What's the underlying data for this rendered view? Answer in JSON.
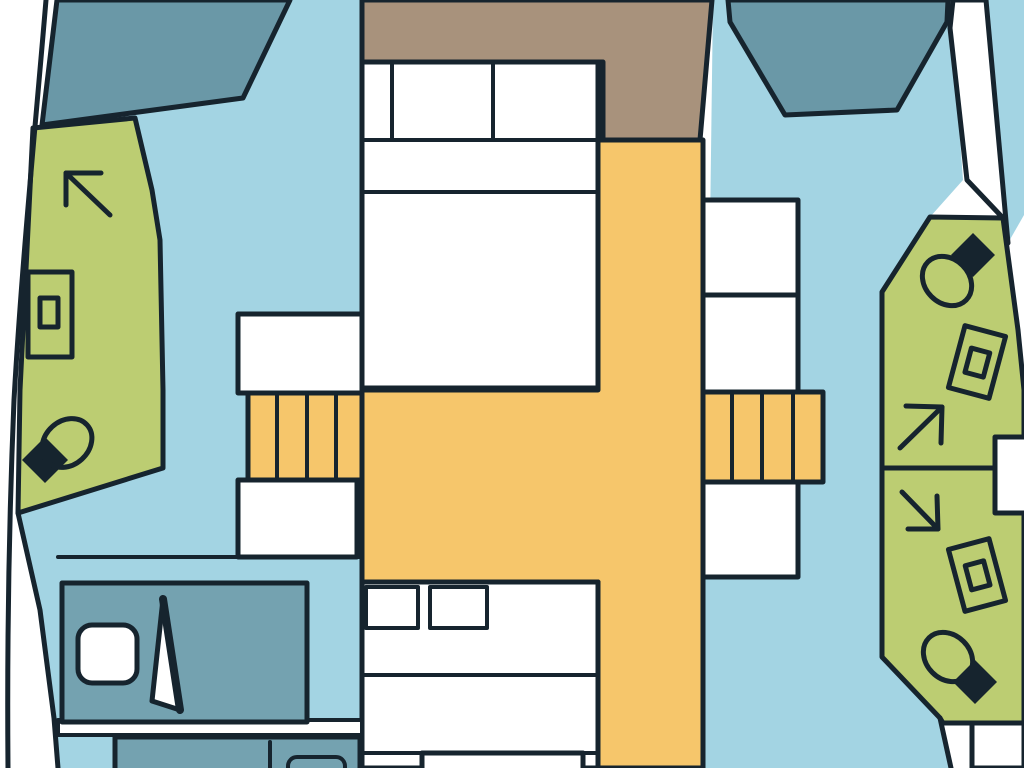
{
  "meta": {
    "type": "boat-floorplan-diagram",
    "subject": "catamaran-deck-layout-top-view",
    "canvas": {
      "width": 1024,
      "height": 768
    },
    "text_content": "none"
  },
  "colors": {
    "outline": "#16242e",
    "white": "#ffffff",
    "hull_interior": "#a3d4e3",
    "window_glass": "#6a98a7",
    "berth_teal": "#74a2b0",
    "bathroom_green": "#bccd72",
    "saloon_orange": "#f6c66b",
    "foredeck_tan": "#a8927c"
  },
  "rooms": [
    {
      "id": "left-hull",
      "fill": "hull_interior"
    },
    {
      "id": "right-hull",
      "fill": "hull_interior"
    },
    {
      "id": "foredeck",
      "fill": "foredeck_tan"
    },
    {
      "id": "saloon-walkway",
      "fill": "saloon_orange"
    },
    {
      "id": "left-bathroom",
      "fill": "bathroom_green",
      "fixtures": [
        "shower-arrow",
        "sink",
        "toilet"
      ]
    },
    {
      "id": "right-bathroom-upper",
      "fill": "bathroom_green",
      "fixtures": [
        "toilet",
        "sink",
        "shower-arrow"
      ]
    },
    {
      "id": "right-bathroom-lower",
      "fill": "bathroom_green",
      "fixtures": [
        "shower-arrow",
        "sink",
        "toilet"
      ]
    },
    {
      "id": "forward-cabin-bed",
      "fill": "white"
    },
    {
      "id": "aft-cabin-bed",
      "fill": "white"
    },
    {
      "id": "left-aft-berth",
      "fill": "berth_teal"
    },
    {
      "id": "left-galley-counter",
      "fill": "berth_teal"
    },
    {
      "id": "window-left",
      "fill": "window_glass"
    },
    {
      "id": "window-right",
      "fill": "window_glass"
    }
  ],
  "fixtures": {
    "toilets": 3,
    "sinks": 3,
    "shower_arrows": 3,
    "staircases": 2,
    "stair_steps_each": 4,
    "pillows_forward_bed": 2,
    "pillows_aft_bed": 2
  }
}
